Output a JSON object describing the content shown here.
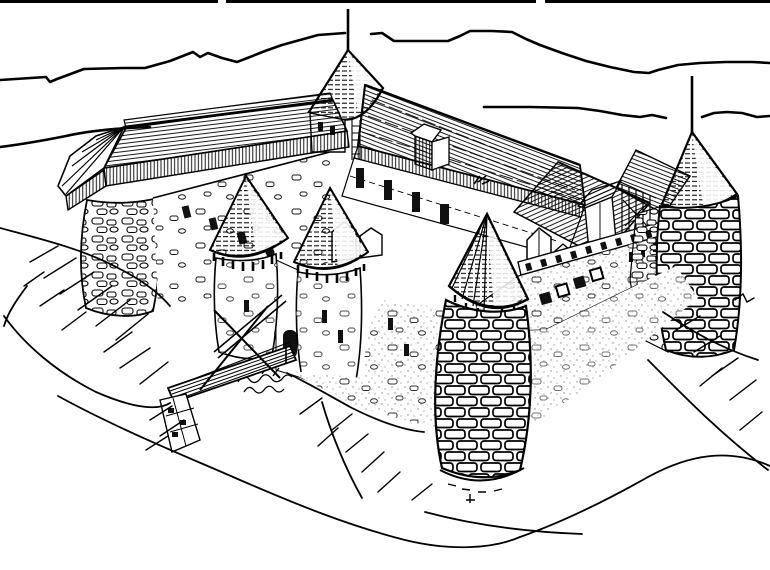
{
  "meta": {
    "alt_text": "Black-and-white hand-drawn line illustration (coloring-page style) of a medieval hilltop castle with round towers and conical roofs, a wooden trestle bridge on the left, hatched rocky slopes below and mountain ridgelines in the background."
  },
  "palette": {
    "ink": "#000000",
    "paper": "#ffffff"
  },
  "scene": {
    "background": {
      "top_border_line": true,
      "mountain_ridges": 2,
      "shoreline_left": true
    },
    "castle": {
      "flagpoles": 2,
      "towers": [
        {
          "id": "left-bastion",
          "features": "round rubble-stone tower capped by the covered wall-walk roof"
        },
        {
          "id": "keep-spire",
          "features": "conical spire with tall flagpole at top center"
        },
        {
          "id": "gatehouse-tower-west",
          "features": "conical roof with hanging machicolation corbels"
        },
        {
          "id": "gatehouse-tower-east",
          "features": "conical roof with hanging machicolation corbels"
        },
        {
          "id": "front-drum-tower",
          "features": "massive round tower, bold coursed masonry, conical cap"
        },
        {
          "id": "right-corner-tower",
          "features": "round corner tower, coursed masonry, conical roof with flagpole"
        }
      ],
      "roofs": "long shingled ranges with a gabled dormer, white gable dormers, timber framing and plank fascias",
      "walls": "white curtain walls with scattered stone marks, stippled revetments, dark window openings",
      "bridge": "wooden ramp bridge with longitudinal planks, X cross-bracing and a checkered stone pier",
      "terrain": "rocky outcrop with long wavy contour lines and short hatch strokes"
    }
  }
}
